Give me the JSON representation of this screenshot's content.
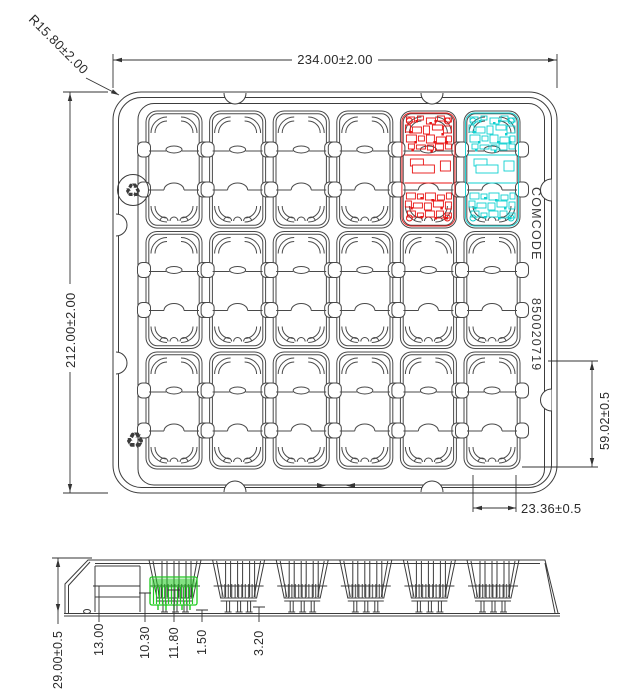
{
  "top_view": {
    "dim_overall_width": "234.00±2.00",
    "dim_overall_height": "212.00±2.00",
    "dim_corner_radius": "R15.80±2.00",
    "dim_pocket_height": "59.02±0.5",
    "dim_pocket_pitch": "23.36±0.5",
    "comcode_label": "COMCODE",
    "comcode_value": "850020719",
    "recycle_symbol": "♻",
    "grid_rows": 3,
    "grid_cols": 6
  },
  "side_view": {
    "dim_overall_height": "29.00±0.5",
    "dim_ledge_height": "13.00",
    "dim_pocket_depth_a": "10.30",
    "dim_pocket_depth_b": "11.80",
    "dim_clearance": "1.50",
    "dim_rib_width": "3.20"
  },
  "colors": {
    "line": "#3c3c3c",
    "highlight_red": "#e81313",
    "highlight_cyan": "#0fd0d0",
    "highlight_green": "#1ecb1e"
  }
}
